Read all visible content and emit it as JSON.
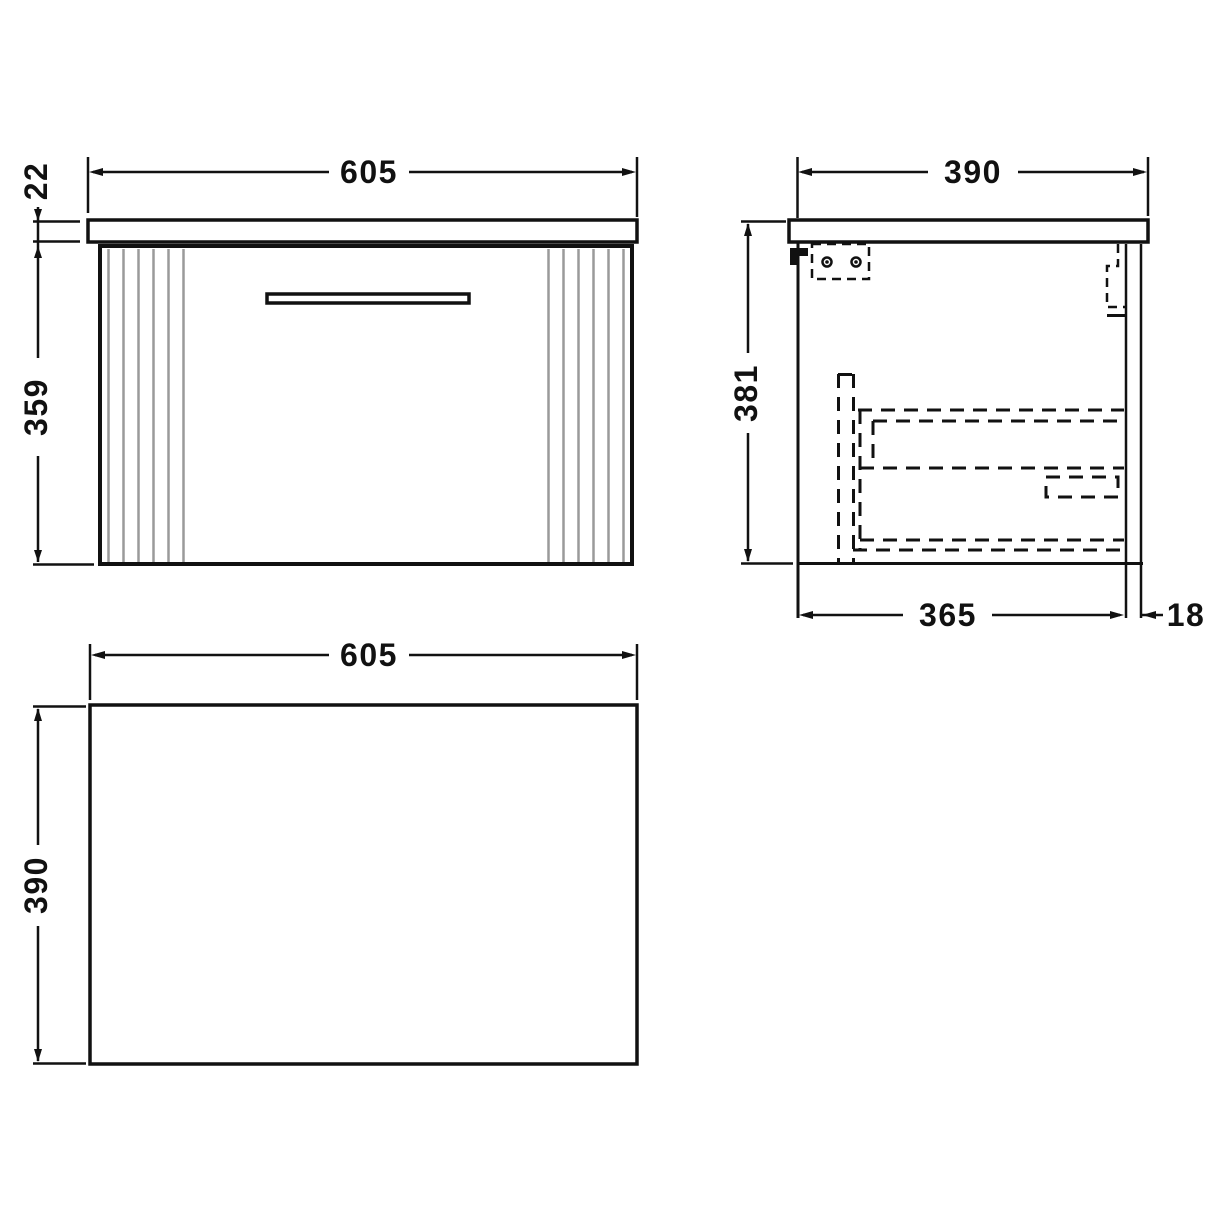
{
  "colors": {
    "background": "#ffffff",
    "line": "#111111",
    "flute": "#9a9a9a"
  },
  "views": {
    "front": {
      "width": "605",
      "counter_thickness": "22",
      "body_height": "359"
    },
    "side": {
      "depth": "390",
      "height": "381",
      "body_depth": "365",
      "front_panel_thickness": "18"
    },
    "plan": {
      "width": "605",
      "depth": "390"
    }
  }
}
